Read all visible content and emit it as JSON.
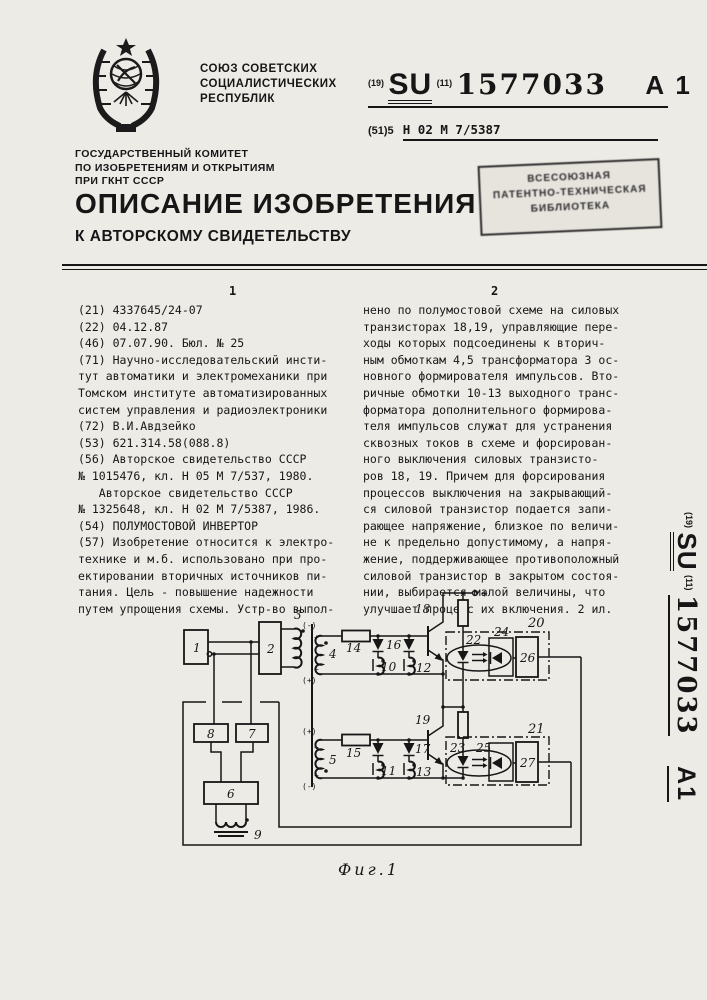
{
  "masthead": {
    "union": "СОЮЗ СОВЕТСКИХ\nСОЦИАЛИСТИЧЕСКИХ\nРЕСПУБЛИК",
    "committee": "ГОСУДАРСТВЕННЫЙ КОМИТЕТ\nПО ИЗОБРЕТЕНИЯМ И ОТКРЫТИЯМ\nПРИ ГКНТ СССР",
    "title": "ОПИСАНИЕ ИЗОБРЕТЕНИЯ",
    "subtitle": "К АВТОРСКОМУ СВИДЕТЕЛЬСТВУ"
  },
  "pub": {
    "c19": "(19)",
    "country": "SU",
    "c11": "(11)",
    "number": "1577033",
    "kind": "А 1",
    "kind_side": "А1",
    "c51": "(51)5",
    "ipc": "Н 02 М 7/5387"
  },
  "stamp": {
    "text": "ВСЕСОЮЗНАЯ\nПАТЕНТНО-ТЕХНИЧЕСКАЯ\nБИБЛИОТЕКА"
  },
  "body": {
    "col1_marker": "1",
    "col2_marker": "2",
    "left_column": "(21) 4337645/24-07\n(22) 04.12.87\n(46) 07.07.90. Бюл. № 25\n(71) Научно-исследовательский инсти-\nтут автоматики и электромеханики при\nТомском институте автоматизированных\nсистем управления и радиоэлектроники\n(72) В.И.Авдзейко\n(53) 621.314.58(088.8)\n(56) Авторское свидетельство СССР\n№ 1015476, кл. Н 05 М 7/537, 1980.\n   Авторское свидетельство СССР\n№ 1325648, кл. Н 02 М 7/5387, 1986.\n(54) ПОЛУМОСТОВОЙ ИНВЕРТОР\n(57) Изобретение относится к электро-\nтехнике и м.б. использовано при про-\nектировании вторичных источников пи-\nтания. Цель - повышение надежности\nпутем упрощения схемы. Устр-во выпол-",
    "right_column": "нено по полумостовой схеме на силовых\nтранзисторах 18,19, управляющие пере-\nходы которых подсоединены к вторич-\nным обмоткам 4,5 трансформатора 3 ос-\nновного формирователя импульсов. Вто-\nричные обмотки 10-13 выходного транс-\nформатора дополнительного формирова-\nтеля импульсов служат для устранения\nсквозных токов в схеме и форсирован-\nного выключения силовых транзисто-\nров 18, 19. Причем для форсирования\nпроцессов выключения на закрывающий-\nся силовой транзистор подается запи-\nрающее напряжение, близкое по величи-\nне к предельно допустимому, а напря-\nжение, поддерживающее противоположный\nсиловой транзистор в закрытом состоя-\nнии, выбирается малой величины, что\nулучшает процесс их включения. 2 ил."
  },
  "figure": {
    "caption": "Фиг.1",
    "labels": {
      "b1": "1",
      "b2": "2",
      "t3": "3",
      "w4": "4",
      "w5": "5",
      "b6": "6",
      "b7": "7",
      "b8": "8",
      "t9": "9",
      "w10": "10",
      "w11": "11",
      "w12": "12",
      "w13": "13",
      "r14": "14",
      "r15": "15",
      "d16": "16",
      "d17": "17",
      "q18": "18",
      "q19": "19",
      "oc20": "20",
      "oc21": "21",
      "l22": "22",
      "l23": "23",
      "p24": "24",
      "p25": "25",
      "b26": "26",
      "b27": "27"
    },
    "marks": {
      "plus": "+",
      "minus": "−",
      "plus_p": "(+)",
      "minus_p": "(-)"
    }
  }
}
